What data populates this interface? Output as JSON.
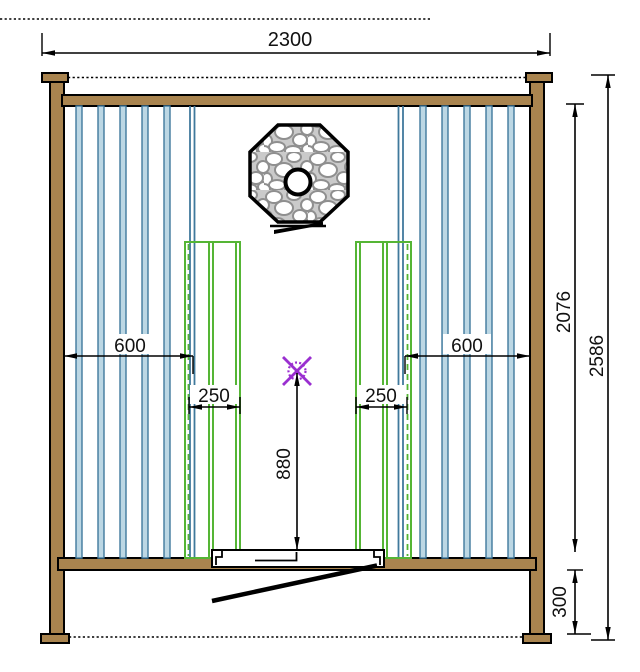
{
  "drawing": {
    "dimensions": {
      "overall_width_mm": "2300",
      "left_wall_to_bench_mm": "600",
      "left_bench_depth_mm": "250",
      "right_wall_to_bench_mm": "600",
      "right_bench_depth_mm": "250",
      "lamp_height_mm": "880",
      "frame_height_mm": "2076",
      "total_height_mm": "2586",
      "base_height_mm": "300"
    },
    "colors": {
      "wood": "#a9844f",
      "outline": "#000000",
      "slat_fill": "#bcd7e4",
      "slat_stroke": "#40799c",
      "bench_green": "#55b535",
      "lamp_purple": "#9a2fd0",
      "stone_gray": "#8f8f8f",
      "stone_bg": "#cacaca",
      "dim_text": "#111111"
    }
  }
}
